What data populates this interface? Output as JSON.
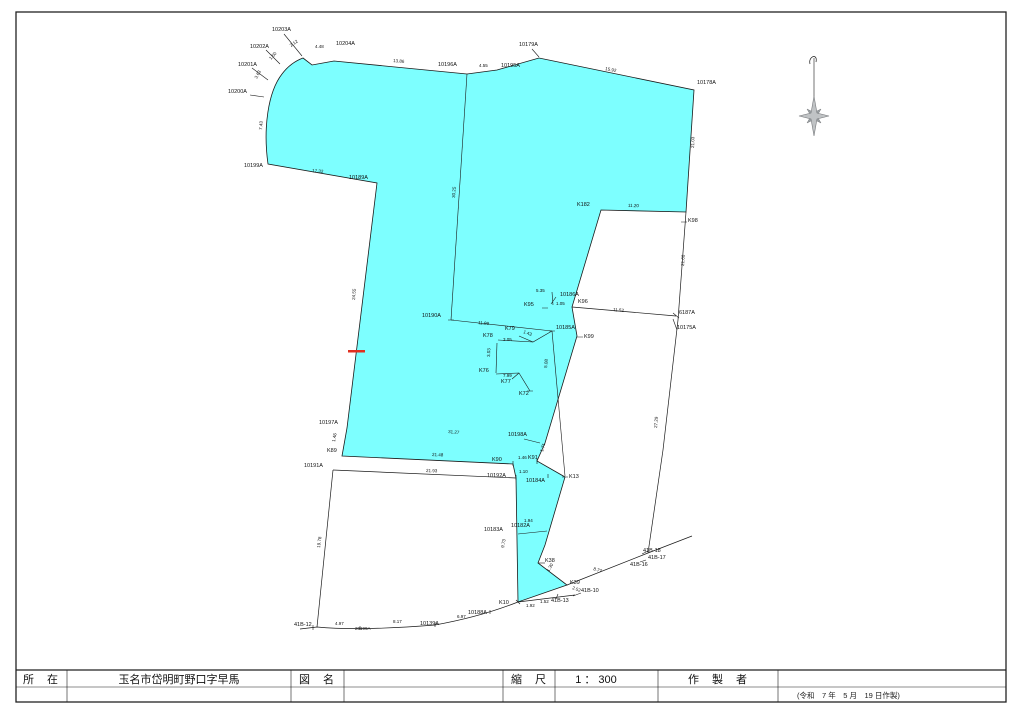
{
  "title_block": {
    "location_label": "所　在",
    "location_value": "玉名市岱明町野口字早馬",
    "map_name_label": "図　名",
    "map_name_value": "",
    "scale_label": "縮　尺",
    "scale_value": "1 ： 300",
    "author_label": "作　製　者",
    "author_value": "",
    "date_note": "(令和　7 年　5 月　19 日作製)"
  },
  "colors": {
    "parcel_fill": "#7dffff",
    "line": "#1a1a1a",
    "red_mark": "#e03020",
    "compass_fill": "#c0c3c5",
    "compass_dark": "#9aa0a3"
  },
  "icons": {
    "compass": "compass-rose",
    "north_needle": "north-needle"
  },
  "map_labels": [
    {
      "t": "10203A",
      "x": 272,
      "y": 31
    },
    {
      "t": "2.12",
      "x": 291,
      "y": 47,
      "r": -35,
      "s": 4.5
    },
    {
      "t": "10202A",
      "x": 250,
      "y": 48
    },
    {
      "t": "1.50",
      "x": 271,
      "y": 60,
      "r": -48,
      "s": 4.5
    },
    {
      "t": "10201A",
      "x": 238,
      "y": 66
    },
    {
      "t": "3.63",
      "x": 257,
      "y": 79,
      "r": -62,
      "s": 4.5
    },
    {
      "t": "10200A",
      "x": 228,
      "y": 93
    },
    {
      "t": "7.43",
      "x": 262,
      "y": 130,
      "r": -85,
      "s": 4.5
    },
    {
      "t": "4.48",
      "x": 315,
      "y": 48,
      "s": 4.5
    },
    {
      "t": "10204A",
      "x": 336,
      "y": 45
    },
    {
      "t": "13.86",
      "x": 393,
      "y": 62,
      "r": 5,
      "s": 4.5
    },
    {
      "t": "10196A",
      "x": 438,
      "y": 66
    },
    {
      "t": "4.55",
      "x": 479,
      "y": 67,
      "s": 4.5
    },
    {
      "t": "10195A",
      "x": 501,
      "y": 67
    },
    {
      "t": "10179A",
      "x": 519,
      "y": 46
    },
    {
      "t": "15.92",
      "x": 605,
      "y": 70,
      "r": 11,
      "s": 4.5
    },
    {
      "t": "10178A",
      "x": 697,
      "y": 84
    },
    {
      "t": "21.03",
      "x": 694,
      "y": 148,
      "r": -88,
      "s": 4.5
    },
    {
      "t": "K182",
      "x": 577,
      "y": 206
    },
    {
      "t": "11.20",
      "x": 628,
      "y": 207,
      "r": 1,
      "s": 4.5
    },
    {
      "t": "K98",
      "x": 688,
      "y": 222
    },
    {
      "t": "21.60",
      "x": 684,
      "y": 266,
      "r": -86,
      "s": 4.5
    },
    {
      "t": "10199A",
      "x": 244,
      "y": 167
    },
    {
      "t": "17.32",
      "x": 312,
      "y": 172,
      "r": 5,
      "s": 4.5
    },
    {
      "t": "10189A",
      "x": 349,
      "y": 179
    },
    {
      "t": "30.25",
      "x": 455,
      "y": 198,
      "r": -86,
      "s": 4.5
    },
    {
      "t": "24.55",
      "x": 355,
      "y": 300,
      "r": -86,
      "s": 4.5
    },
    {
      "t": "10190A",
      "x": 422,
      "y": 317
    },
    {
      "t": "11.99",
      "x": 478,
      "y": 324,
      "r": 6,
      "s": 4.5
    },
    {
      "t": "5.35",
      "x": 536,
      "y": 292,
      "s": 4.5
    },
    {
      "t": "10186A",
      "x": 560,
      "y": 296
    },
    {
      "t": "K95",
      "x": 524,
      "y": 306
    },
    {
      "t": "1.05",
      "x": 556,
      "y": 305,
      "s": 4.5
    },
    {
      "t": "K96",
      "x": 578,
      "y": 303
    },
    {
      "t": "11.52",
      "x": 613,
      "y": 311,
      "r": 5,
      "s": 4.5
    },
    {
      "t": "6187A",
      "x": 679,
      "y": 314
    },
    {
      "t": "10175A",
      "x": 677,
      "y": 329
    },
    {
      "t": "K99",
      "x": 584,
      "y": 338
    },
    {
      "t": "K79",
      "x": 505,
      "y": 330
    },
    {
      "t": "1.43",
      "x": 523,
      "y": 333,
      "r": 20,
      "s": 4.5
    },
    {
      "t": "K78",
      "x": 483,
      "y": 337
    },
    {
      "t": "3.05",
      "x": 503,
      "y": 341,
      "s": 4.5
    },
    {
      "t": "10185A",
      "x": 556,
      "y": 329
    },
    {
      "t": "3.03",
      "x": 490,
      "y": 357,
      "r": -88,
      "s": 4.5
    },
    {
      "t": "K76",
      "x": 479,
      "y": 372
    },
    {
      "t": "7.99",
      "x": 503,
      "y": 377,
      "s": 4.5
    },
    {
      "t": "K77",
      "x": 501,
      "y": 383
    },
    {
      "t": "K72",
      "x": 519,
      "y": 395
    },
    {
      "t": "5.08",
      "x": 547,
      "y": 368,
      "r": -84,
      "s": 4.5
    },
    {
      "t": "27.29",
      "x": 657,
      "y": 428,
      "r": -85,
      "s": 4.5
    },
    {
      "t": "10197A",
      "x": 319,
      "y": 424
    },
    {
      "t": "31.27",
      "x": 448,
      "y": 433,
      "r": 5,
      "s": 4.5
    },
    {
      "t": "10198A",
      "x": 508,
      "y": 436
    },
    {
      "t": "1.71",
      "x": 543,
      "y": 452,
      "r": -75,
      "s": 4.5
    },
    {
      "t": "K89",
      "x": 327,
      "y": 452
    },
    {
      "t": "1.46",
      "x": 335,
      "y": 442,
      "r": -80,
      "s": 4.5
    },
    {
      "t": "21.48",
      "x": 432,
      "y": 456,
      "r": 2,
      "s": 4.5
    },
    {
      "t": "K90",
      "x": 492,
      "y": 461
    },
    {
      "t": "1.46",
      "x": 518,
      "y": 459,
      "s": 4.5
    },
    {
      "t": "K91",
      "x": 528,
      "y": 459
    },
    {
      "t": "10191A",
      "x": 304,
      "y": 467
    },
    {
      "t": "21.93",
      "x": 426,
      "y": 472,
      "r": 2,
      "s": 4.5
    },
    {
      "t": "10192A",
      "x": 487,
      "y": 477
    },
    {
      "t": "1.10",
      "x": 519,
      "y": 473,
      "s": 4.5
    },
    {
      "t": "10184A",
      "x": 526,
      "y": 482
    },
    {
      "t": "K13",
      "x": 569,
      "y": 478
    },
    {
      "t": "19.78",
      "x": 320,
      "y": 548,
      "r": -83,
      "s": 4.5
    },
    {
      "t": "9.73",
      "x": 504,
      "y": 548,
      "r": -80,
      "s": 4.5
    },
    {
      "t": "10183A",
      "x": 484,
      "y": 531
    },
    {
      "t": "1.94",
      "x": 524,
      "y": 522,
      "s": 4.5
    },
    {
      "t": "10182A",
      "x": 511,
      "y": 527
    },
    {
      "t": "K38",
      "x": 545,
      "y": 562
    },
    {
      "t": "1.30",
      "x": 549,
      "y": 572,
      "r": -60,
      "s": 4.5
    },
    {
      "t": "K39",
      "x": 570,
      "y": 584
    },
    {
      "t": "2.52",
      "x": 572,
      "y": 589,
      "r": 20,
      "s": 4.5
    },
    {
      "t": "8.77",
      "x": 593,
      "y": 570,
      "r": 18,
      "s": 4.5
    },
    {
      "t": "41B-18",
      "x": 643,
      "y": 552
    },
    {
      "t": "41B-17",
      "x": 648,
      "y": 559
    },
    {
      "t": "41B-16",
      "x": 630,
      "y": 566
    },
    {
      "t": "41B-13",
      "x": 551,
      "y": 602
    },
    {
      "t": "41B-10",
      "x": 581,
      "y": 592
    },
    {
      "t": "1.92",
      "x": 526,
      "y": 607,
      "s": 4.5
    },
    {
      "t": "1.52",
      "x": 540,
      "y": 603,
      "s": 4.5
    },
    {
      "t": "K10",
      "x": 499,
      "y": 604
    },
    {
      "t": "41B-12",
      "x": 294,
      "y": 626
    },
    {
      "t": "4.97",
      "x": 335,
      "y": 625,
      "s": 4.5
    },
    {
      "t": "20199A",
      "x": 355,
      "y": 630,
      "s": 4.5
    },
    {
      "t": "8.17",
      "x": 393,
      "y": 623,
      "s": 4.5
    },
    {
      "t": "10139A",
      "x": 420,
      "y": 625
    },
    {
      "t": "6.97",
      "x": 457,
      "y": 618,
      "s": 4.5
    },
    {
      "t": "10188A",
      "x": 468,
      "y": 614
    }
  ]
}
